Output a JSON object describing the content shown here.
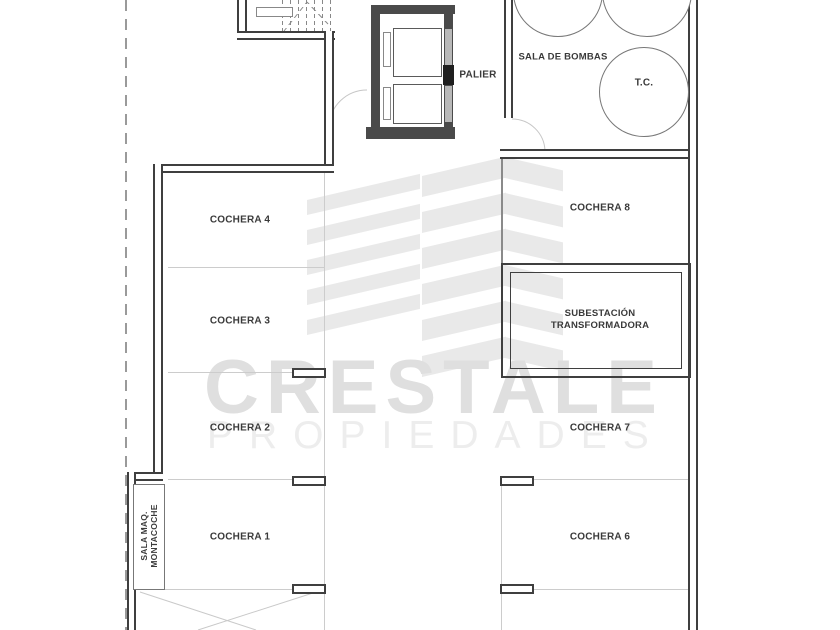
{
  "plan_title": "parking-level-floor-plan",
  "labels": {
    "palier": "PALIER",
    "sala_de_bombas": "SALA DE BOMBAS",
    "tank": "T.C.",
    "subestacion_line1": "SUBESTACIÓN",
    "subestacion_line2": "TRANSFORMADORA",
    "sala_maq_line1": "SALA MAQ.",
    "sala_maq_line2": "MONTACOCHE",
    "cochera_1": "COCHERA 1",
    "cochera_2": "COCHERA 2",
    "cochera_3": "COCHERA 3",
    "cochera_4": "COCHERA 4",
    "cochera_6": "COCHERA 6",
    "cochera_7": "COCHERA 7",
    "cochera_8": "COCHERA 8"
  },
  "watermark": {
    "brand": "CRESTALE",
    "subtitle": "PROPIEDADES"
  },
  "colors": {
    "wall": "#3f3f3f",
    "medium_line": "#8a8a8a",
    "faint_line": "#cccccc",
    "text": "#3a3a3a",
    "watermark_brand": "#dfdfdf",
    "watermark_subtitle": "#ededed",
    "watermark_logo": "#e9e9e9",
    "background": "#ffffff"
  }
}
